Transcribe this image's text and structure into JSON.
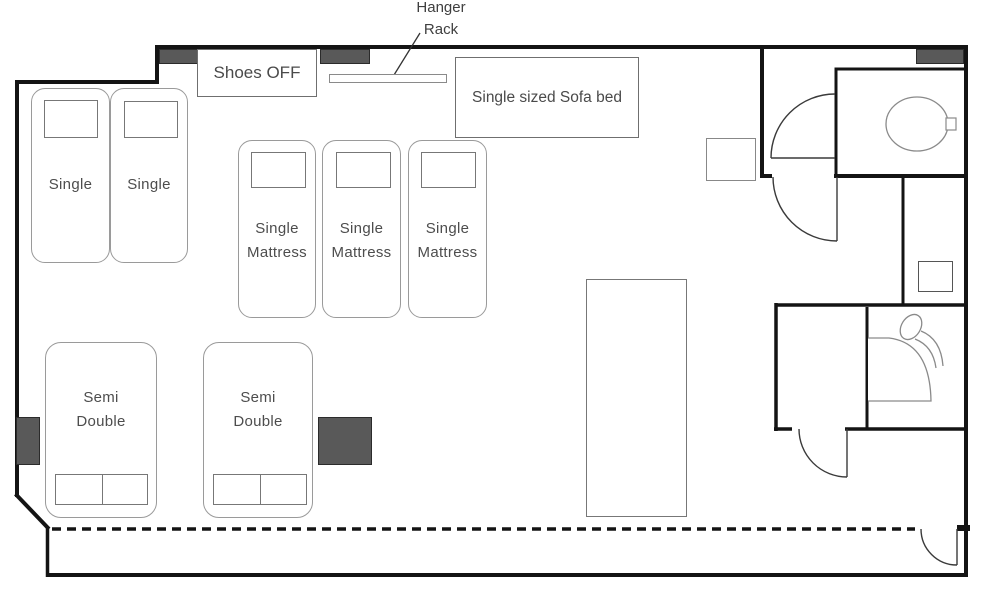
{
  "plan": {
    "shoes_area_label": "Shoes OFF",
    "sofa_bed_label": "Single sized Sofa bed",
    "hanger_label_line1": "Hanger",
    "hanger_label_line2": "Rack"
  },
  "beds": {
    "singles": [
      {
        "label": "Single"
      },
      {
        "label": "Single"
      }
    ],
    "mattresses": [
      {
        "line1": "Single",
        "line2": "Mattress"
      },
      {
        "line1": "Single",
        "line2": "Mattress"
      },
      {
        "line1": "Single",
        "line2": "Mattress"
      }
    ],
    "semi_doubles": [
      {
        "line1": "Semi",
        "line2": "Double"
      },
      {
        "line1": "Semi",
        "line2": "Double"
      }
    ]
  },
  "colors": {
    "wall": "#141414",
    "furniture_outline": "#9a9a9a",
    "dark_block": "#595959",
    "text": "#4d4d4d"
  }
}
